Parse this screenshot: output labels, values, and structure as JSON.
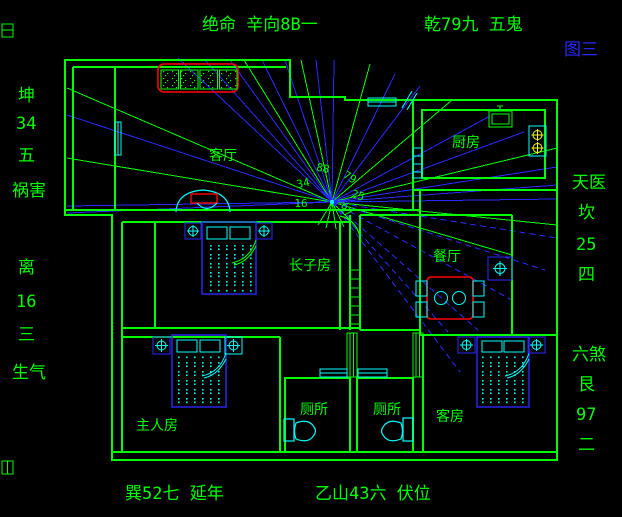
{
  "title": "宅形图 (feng shui floor plan)",
  "annotations": {
    "top": "绝命 辛向8B一",
    "top_right": "乾79九 五鬼",
    "figure_label": "图三",
    "left_upper": [
      "坤",
      "34",
      "五",
      "祸害"
    ],
    "left_lower": [
      "离",
      "16",
      "三",
      "生气"
    ],
    "right_upper": [
      "天医",
      "坎",
      "25",
      "四"
    ],
    "right_lower": [
      "六煞",
      "艮",
      "97",
      "二"
    ],
    "bottom_left": "巽52七 延年",
    "bottom_right": "乙山43六 伏位"
  },
  "rooms": {
    "living_room": "客厅",
    "kitchen": "厨房",
    "dining_room": "餐厅",
    "eldest_son_room": "长子房",
    "master_room": "主人房",
    "toilet_left": "厕所",
    "toilet_right": "厕所",
    "guest_room": "客房"
  },
  "center_numbers": {
    "top": "88",
    "upper_right": "79",
    "upper_left": "34",
    "right": "25",
    "left": "16",
    "lower_right": "97"
  },
  "colors": {
    "background": "#000000",
    "walls_and_text": "#00ff00",
    "compass_rays": "#2a2aff",
    "fixtures": "#00ffff",
    "highlight": "#ff0000",
    "burners": "#ffff00",
    "figure_label": "#2a2aff"
  }
}
